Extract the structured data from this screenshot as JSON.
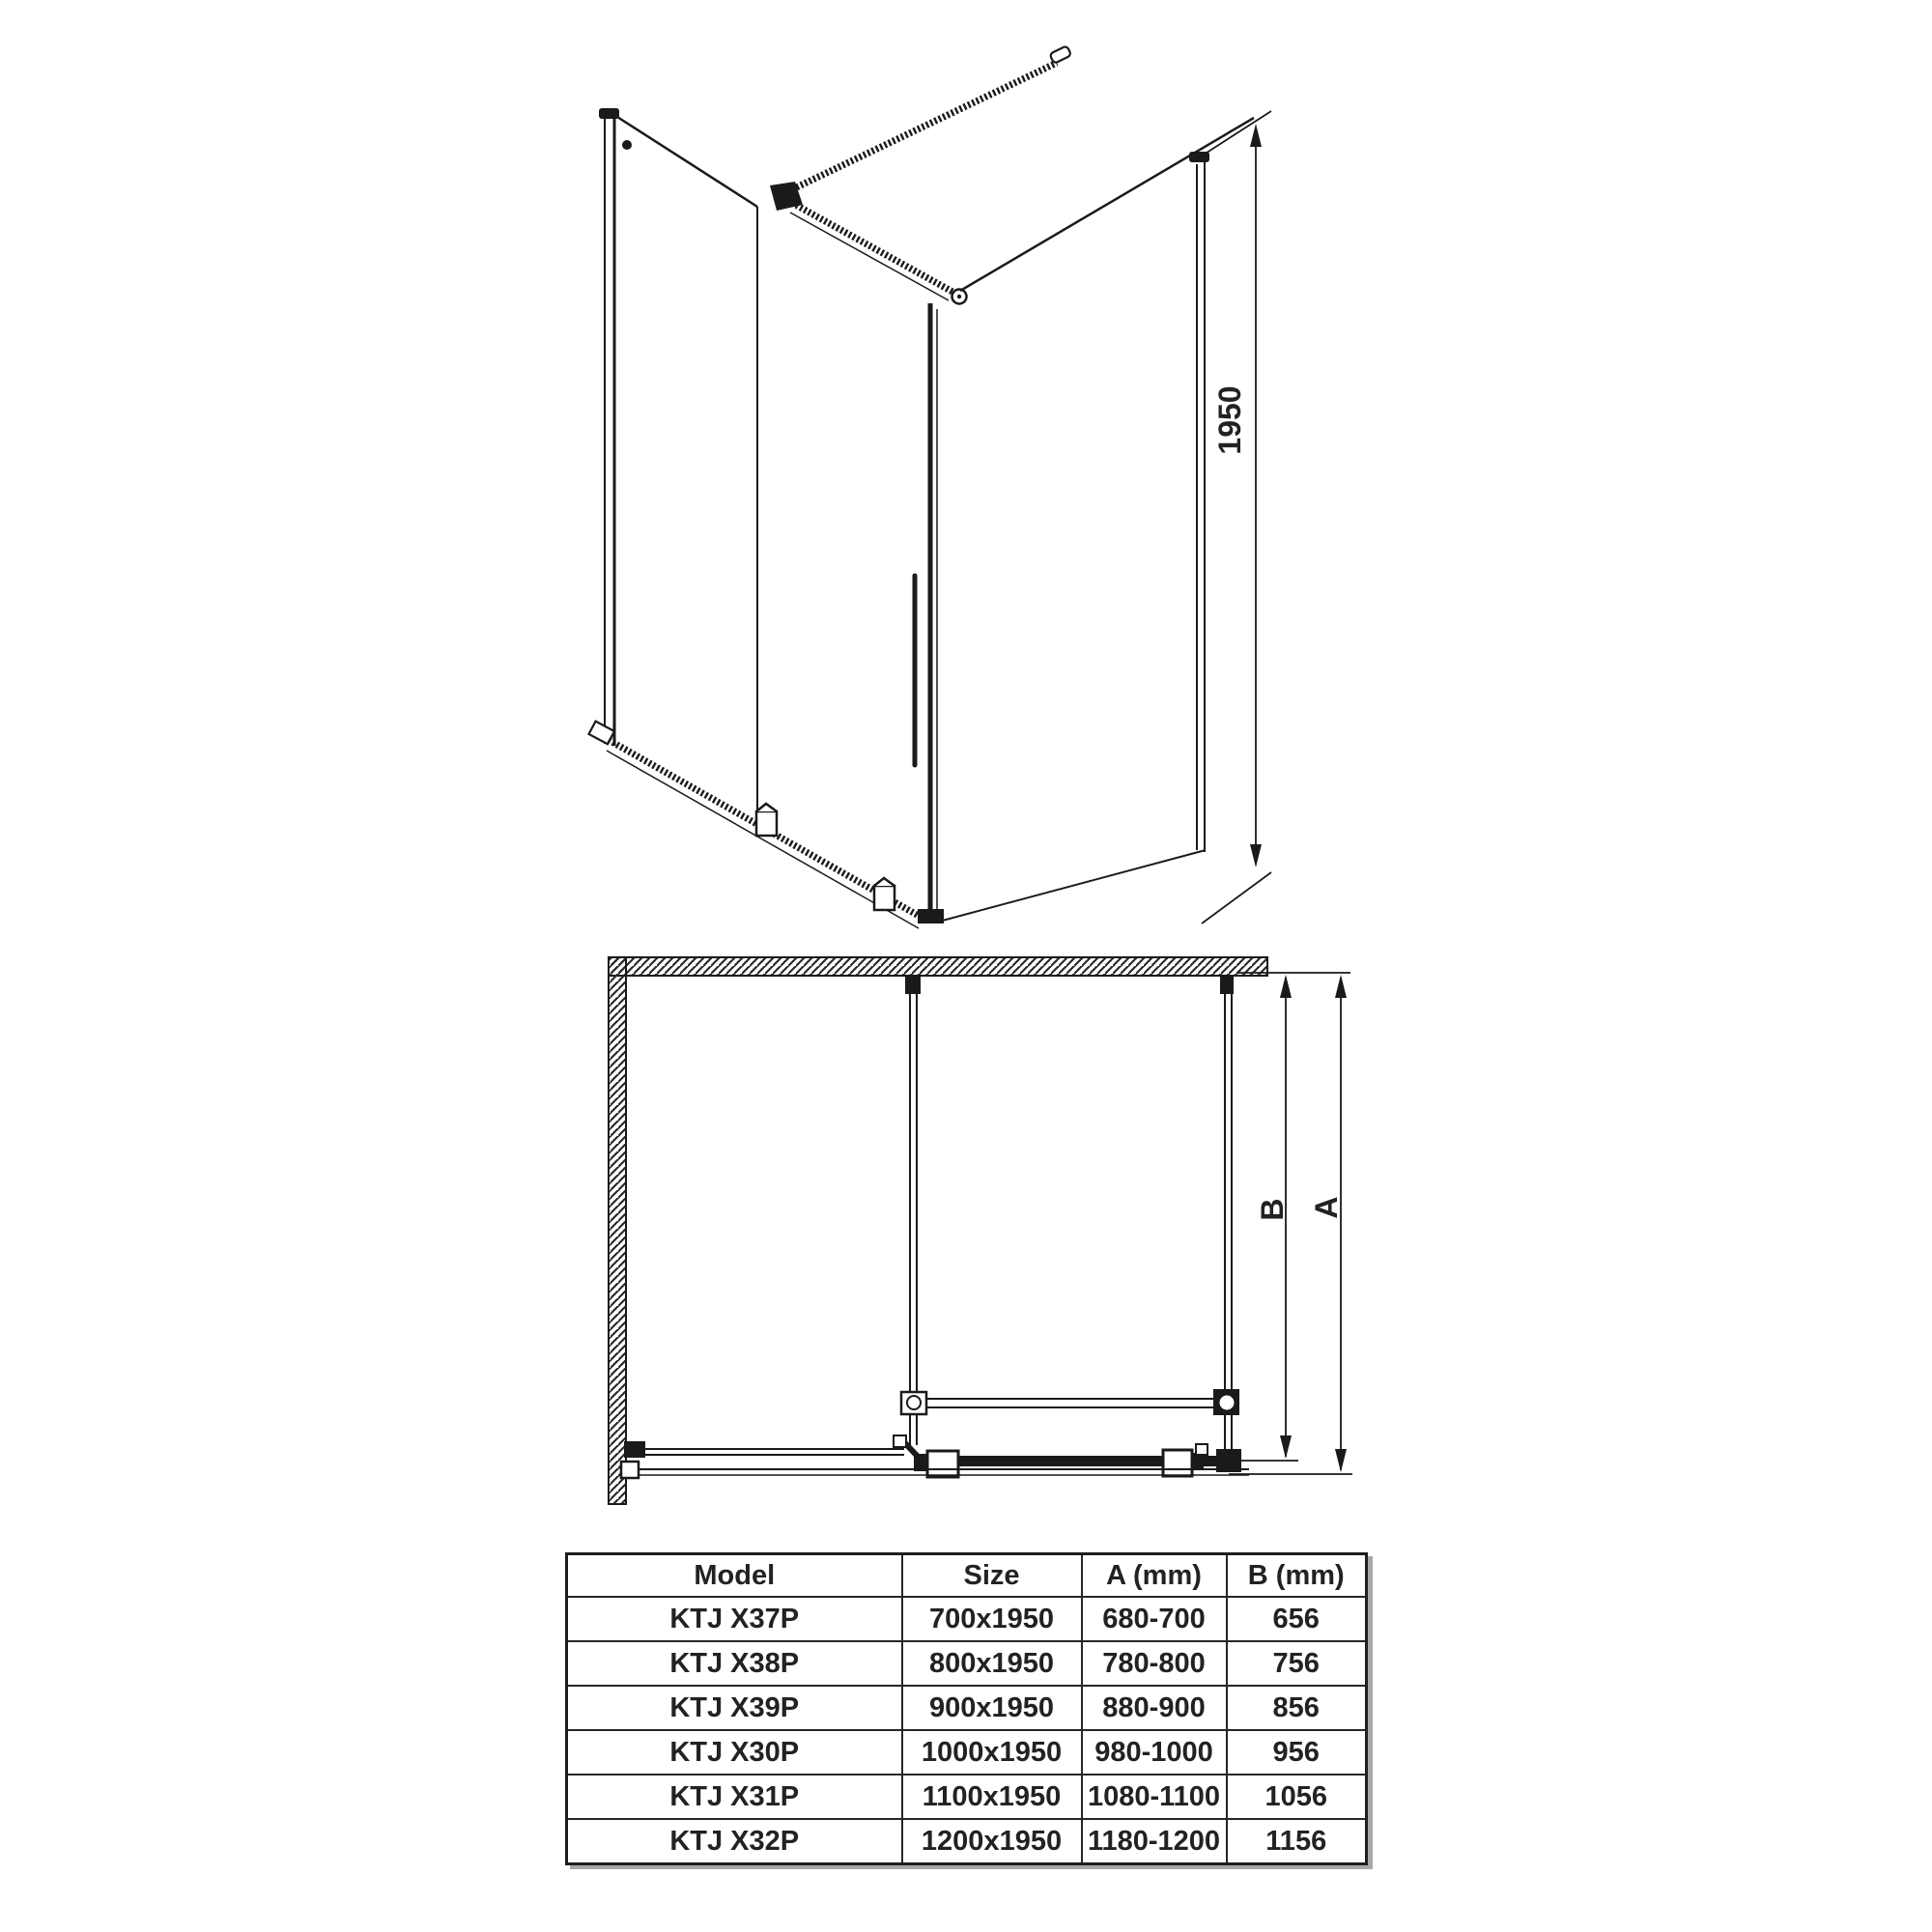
{
  "drawing_3d": {
    "description": "perspective line drawing of corner shower enclosure with sliding door, wall support bar and bottom rail",
    "height_dim_label": "1950"
  },
  "plan": {
    "description": "top-down plan view with L-shaped hatched wall, fixed panel, side glass panel, support bar and door tracks",
    "dim_b_label": "B",
    "dim_a_label": "A"
  },
  "table": {
    "columns": [
      "Model",
      "Size",
      "A (mm)",
      "B (mm)"
    ],
    "rows": [
      [
        "KTJ X37P",
        "700x1950",
        "680-700",
        "656"
      ],
      [
        "KTJ X38P",
        "800x1950",
        "780-800",
        "756"
      ],
      [
        "KTJ X39P",
        "900x1950",
        "880-900",
        "856"
      ],
      [
        "KTJ X30P",
        "1000x1950",
        "980-1000",
        "956"
      ],
      [
        "KTJ X31P",
        "1100x1950",
        "1080-1100",
        "1056"
      ],
      [
        "KTJ X32P",
        "1200x1950",
        "1180-1200",
        "1156"
      ]
    ]
  },
  "colors": {
    "line": "#1a1a1a",
    "text": "#222226",
    "shadow": "#a8a8a8"
  }
}
